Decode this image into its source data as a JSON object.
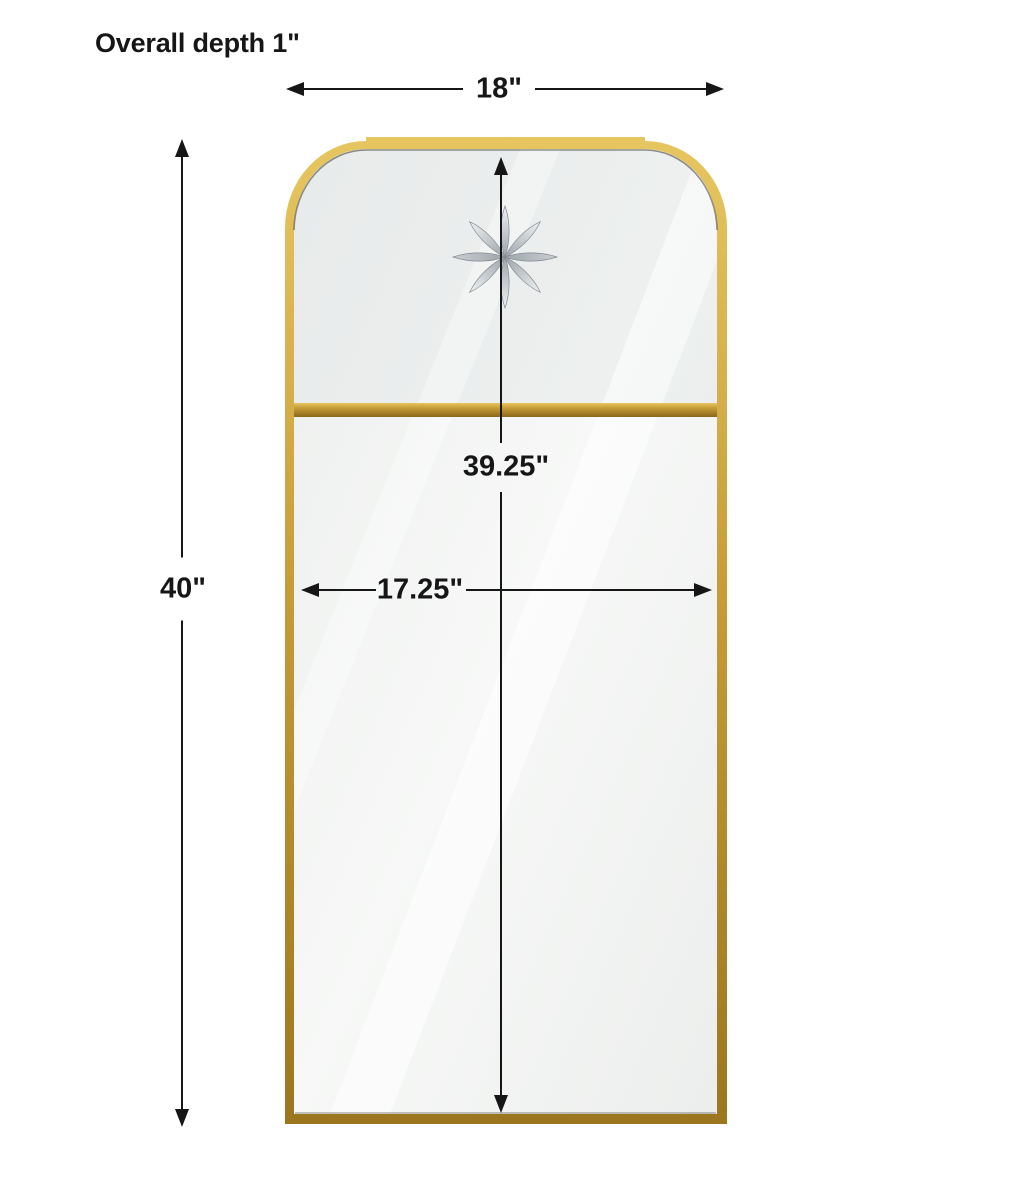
{
  "figure": {
    "kind": "product-dimension-diagram",
    "subject": "gold framed wall mirror with scalloped (clipped-arch) top corners, horizontal gold divider bar and etched 8-point star accent"
  },
  "labels": {
    "overall_depth": "Overall depth 1\"",
    "width": "18\"",
    "height": "40\"",
    "inner_height": "39.25\"",
    "inner_width": "17.25\""
  },
  "colors": {
    "background": "#ffffff",
    "dimension_line": "#161616",
    "gold_light": "#e7c660",
    "gold": "#c79d38",
    "gold_dark": "#9c761f",
    "gold_deep": "#8a671a",
    "glass_light": "#f7f8f7",
    "glass": "#eceeed",
    "glass_tint": "#e2e6e6",
    "frame_shadow": "#3c3a30",
    "star_light": "#eff2f4",
    "star_mid": "#c9ced2",
    "star_dark": "#99a1a8"
  }
}
